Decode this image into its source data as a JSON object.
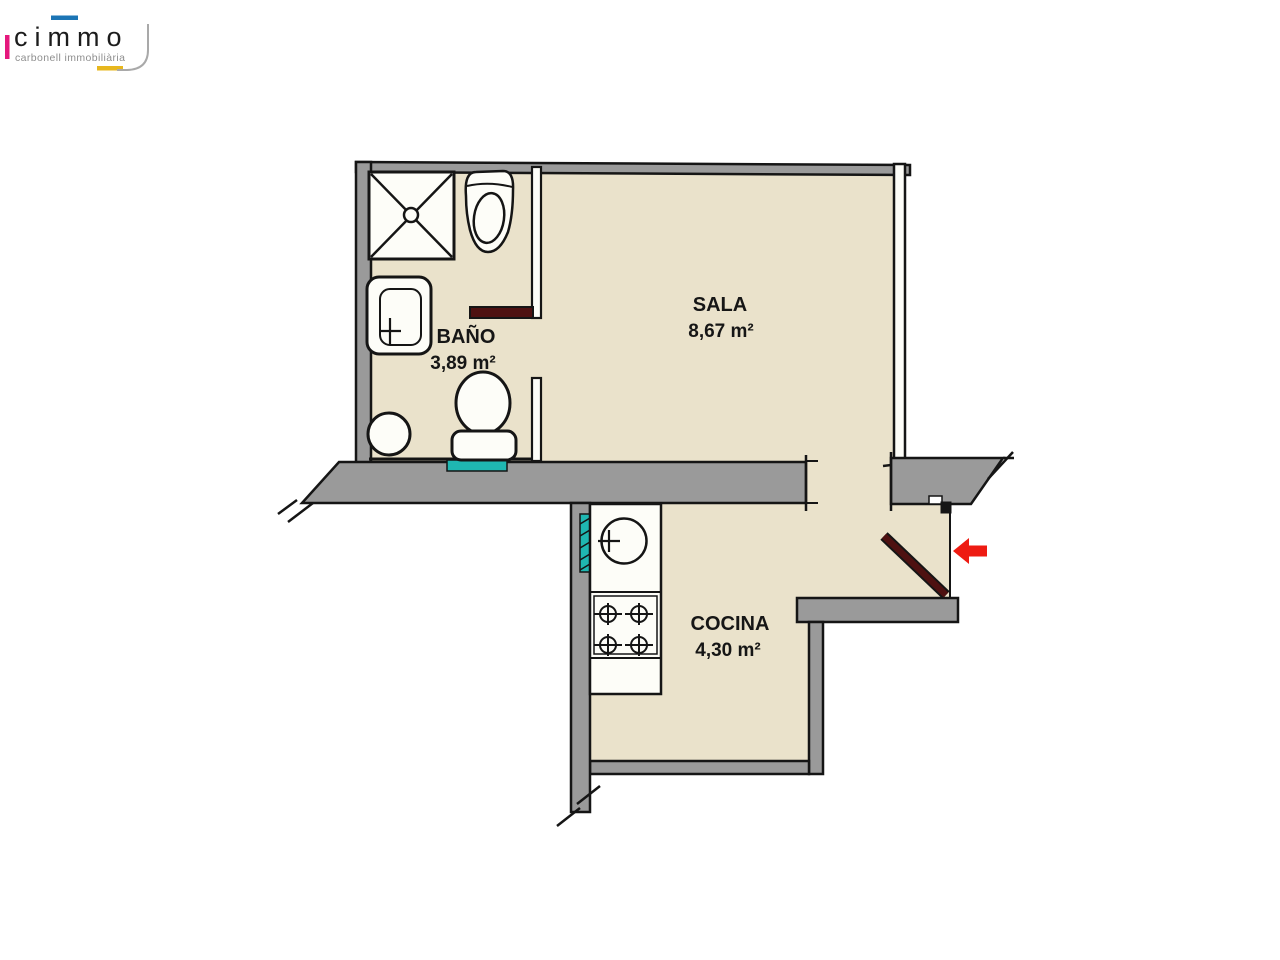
{
  "logo": {
    "brand": "cimmo",
    "tagline": "carbonell immobiliària",
    "accent_pink": "#E5187D",
    "accent_blue": "#1C75B5",
    "accent_yellow": "#E7B71E",
    "curve_grey": "#a9a9a9"
  },
  "floorplan": {
    "wall_color": "#9A9A9A",
    "wall_light_color": "#FDFDF8",
    "floor_color": "#EAE2CB",
    "line_color": "#151515",
    "door_color": "#4E1111",
    "window_color": "#1FB7B1",
    "arrow_color": "#EE1B12",
    "rooms": [
      {
        "name": "BAÑO",
        "area": "3,89 m²"
      },
      {
        "name": "SALA",
        "area": "8,67 m²"
      },
      {
        "name": "COCINA",
        "area": "4,30 m²"
      }
    ]
  }
}
